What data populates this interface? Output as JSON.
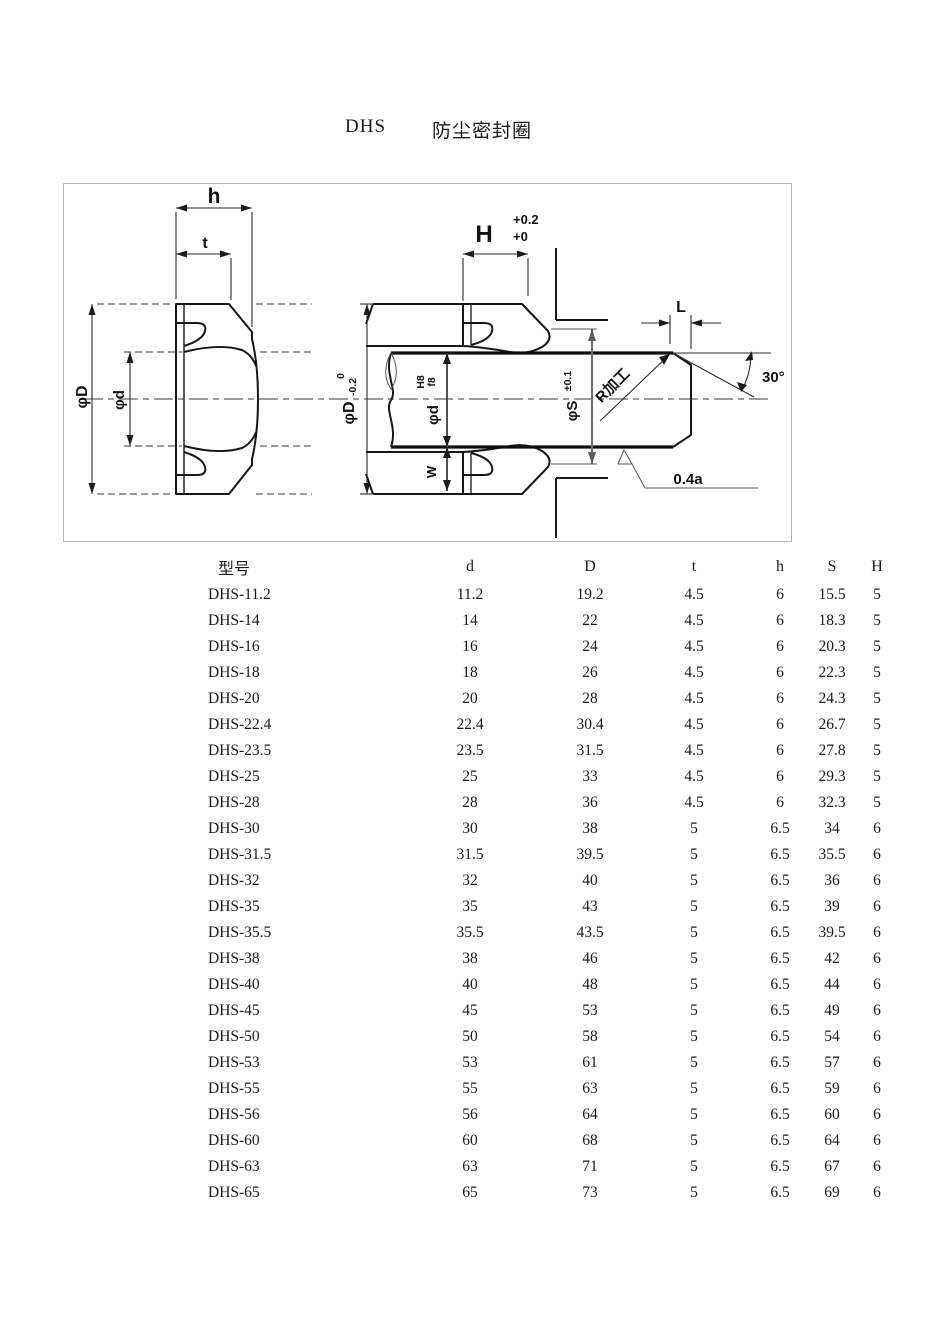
{
  "title": {
    "code": "DHS",
    "name": "防尘密封圈"
  },
  "drawing": {
    "labels": {
      "h": "h",
      "t": "t",
      "phi_D_left": "φD",
      "phi_d_left": "φd",
      "H": "H",
      "H_tol_upper": "+0.2",
      "H_tol_lower": "+0",
      "phi_D_right": "φD",
      "phi_D_tol_upper": "0",
      "phi_D_tol_lower": "-0.2",
      "phi_d_right": "φd",
      "phi_d_fit_upper": "H8",
      "phi_d_fit_lower": "f8",
      "W": "W",
      "phi_S": "φS",
      "phi_S_tol": "±0.1",
      "L": "L",
      "angle": "30°",
      "r_machining": "R加工",
      "roughness": "0.4a"
    }
  },
  "table": {
    "headers": [
      "型号",
      "d",
      "D",
      "t",
      "h",
      "S",
      "H"
    ],
    "rows": [
      [
        "DHS-11.2",
        "11.2",
        "19.2",
        "4.5",
        "6",
        "15.5",
        "5"
      ],
      [
        "DHS-14",
        "14",
        "22",
        "4.5",
        "6",
        "18.3",
        "5"
      ],
      [
        "DHS-16",
        "16",
        "24",
        "4.5",
        "6",
        "20.3",
        "5"
      ],
      [
        "DHS-18",
        "18",
        "26",
        "4.5",
        "6",
        "22.3",
        "5"
      ],
      [
        "DHS-20",
        "20",
        "28",
        "4.5",
        "6",
        "24.3",
        "5"
      ],
      [
        "DHS-22.4",
        "22.4",
        "30.4",
        "4.5",
        "6",
        "26.7",
        "5"
      ],
      [
        "DHS-23.5",
        "23.5",
        "31.5",
        "4.5",
        "6",
        "27.8",
        "5"
      ],
      [
        "DHS-25",
        "25",
        "33",
        "4.5",
        "6",
        "29.3",
        "5"
      ],
      [
        "DHS-28",
        "28",
        "36",
        "4.5",
        "6",
        "32.3",
        "5"
      ],
      [
        "DHS-30",
        "30",
        "38",
        "5",
        "6.5",
        "34",
        "6"
      ],
      [
        "DHS-31.5",
        "31.5",
        "39.5",
        "5",
        "6.5",
        "35.5",
        "6"
      ],
      [
        "DHS-32",
        "32",
        "40",
        "5",
        "6.5",
        "36",
        "6"
      ],
      [
        "DHS-35",
        "35",
        "43",
        "5",
        "6.5",
        "39",
        "6"
      ],
      [
        "DHS-35.5",
        "35.5",
        "43.5",
        "5",
        "6.5",
        "39.5",
        "6"
      ],
      [
        "DHS-38",
        "38",
        "46",
        "5",
        "6.5",
        "42",
        "6"
      ],
      [
        "DHS-40",
        "40",
        "48",
        "5",
        "6.5",
        "44",
        "6"
      ],
      [
        "DHS-45",
        "45",
        "53",
        "5",
        "6.5",
        "49",
        "6"
      ],
      [
        "DHS-50",
        "50",
        "58",
        "5",
        "6.5",
        "54",
        "6"
      ],
      [
        "DHS-53",
        "53",
        "61",
        "5",
        "6.5",
        "57",
        "6"
      ],
      [
        "DHS-55",
        "55",
        "63",
        "5",
        "6.5",
        "59",
        "6"
      ],
      [
        "DHS-56",
        "56",
        "64",
        "5",
        "6.5",
        "60",
        "6"
      ],
      [
        "DHS-60",
        "60",
        "68",
        "5",
        "6.5",
        "64",
        "6"
      ],
      [
        "DHS-63",
        "63",
        "71",
        "5",
        "6.5",
        "67",
        "6"
      ],
      [
        "DHS-65",
        "65",
        "73",
        "5",
        "6.5",
        "69",
        "6"
      ]
    ]
  }
}
